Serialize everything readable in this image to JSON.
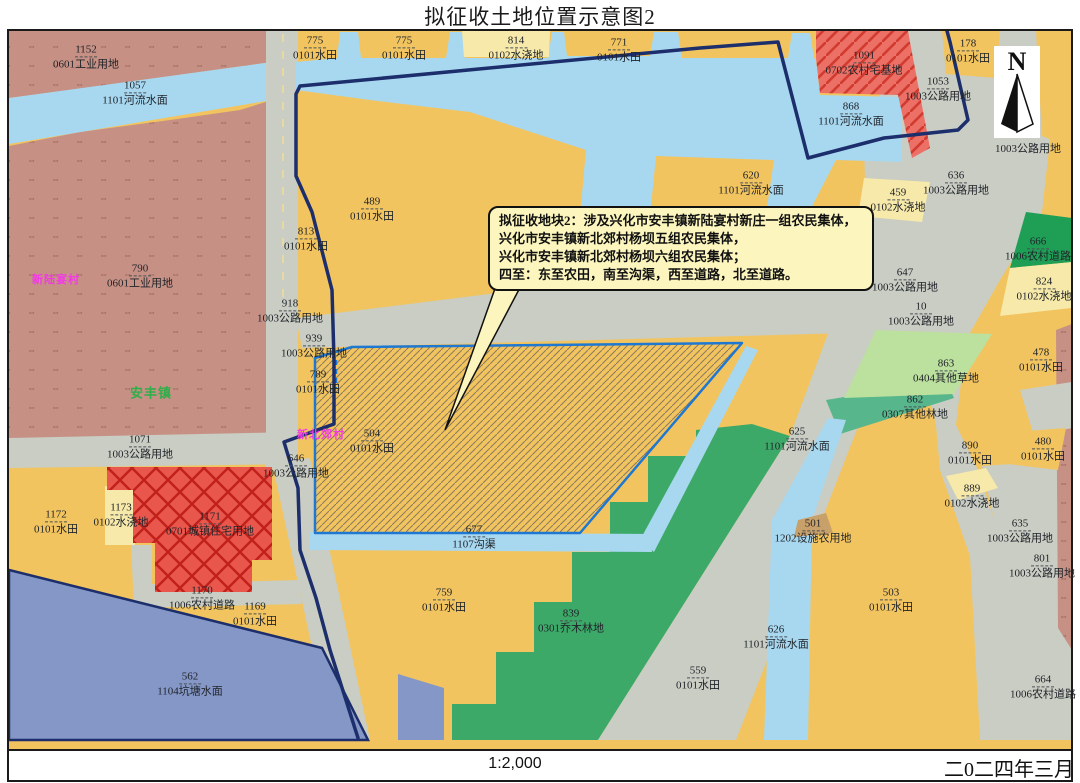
{
  "title": "拟征收土地位置示意图2",
  "footer": {
    "scale": "1:2,000",
    "date": "二0二四年三月"
  },
  "north": {
    "label": "N"
  },
  "callout": {
    "title": "拟征收地块2：",
    "lines": [
      "涉及兴化市安丰镇新陆宴村新庄一组农民集体，",
      "兴化市安丰镇新北郊村杨坝五组农民集体，",
      "兴化市安丰镇新北郊村杨坝六组农民集体；",
      "四至：东至农田，南至沟渠，西至道路，北至道路。"
    ]
  },
  "places": [
    {
      "name": "新陆宴村",
      "x": 56,
      "y": 279,
      "color": "#f23ae6",
      "size": 11
    },
    {
      "name": "安丰镇",
      "x": 151,
      "y": 392,
      "color": "#2fae4a",
      "size": 13
    },
    {
      "name": "新北郊村",
      "x": 321,
      "y": 434,
      "color": "#f23ae6",
      "size": 11
    }
  ],
  "parcels": [
    {
      "n": "1152",
      "u": "0601工业用地",
      "x": 86,
      "y": 57
    },
    {
      "n": "1057",
      "u": "1101河流水面",
      "x": 135,
      "y": 93
    },
    {
      "n": "790",
      "u": "0601工业用地",
      "x": 140,
      "y": 276
    },
    {
      "n": "775",
      "u": "0101水田",
      "x": 315,
      "y": 48
    },
    {
      "n": "775",
      "u": "0101水田",
      "x": 404,
      "y": 48
    },
    {
      "n": "814",
      "u": "0102水浇地",
      "x": 516,
      "y": 48
    },
    {
      "n": "771",
      "u": "0101水田",
      "x": 619,
      "y": 50
    },
    {
      "n": "1091",
      "u": "0702农村宅基地",
      "x": 864,
      "y": 63
    },
    {
      "n": "868",
      "u": "1101河流水面",
      "x": 851,
      "y": 114
    },
    {
      "n": "1053",
      "u": "1003公路用地",
      "x": 938,
      "y": 89
    },
    {
      "n": "178",
      "u": "0101水田",
      "x": 968,
      "y": 51
    },
    {
      "n": "",
      "u": "1003公路用地",
      "x": 1028,
      "y": 149
    },
    {
      "n": "620",
      "u": "1101河流水面",
      "x": 751,
      "y": 183
    },
    {
      "n": "489",
      "u": "0101水田",
      "x": 372,
      "y": 209
    },
    {
      "n": "813",
      "u": "0101水田",
      "x": 306,
      "y": 239
    },
    {
      "n": "918",
      "u": "1003公路用地",
      "x": 290,
      "y": 311
    },
    {
      "n": "939",
      "u": "1003公路用地",
      "x": 314,
      "y": 346
    },
    {
      "n": "789",
      "u": "0101水田",
      "x": 318,
      "y": 382
    },
    {
      "n": "504",
      "u": "0101水田",
      "x": 372,
      "y": 441
    },
    {
      "n": "646",
      "u": "1003公路用地",
      "x": 296,
      "y": 466
    },
    {
      "n": "1071",
      "u": "1003公路用地",
      "x": 140,
      "y": 447
    },
    {
      "n": "636",
      "u": "1003公路用地",
      "x": 956,
      "y": 183
    },
    {
      "n": "459",
      "u": "0102水浇地",
      "x": 898,
      "y": 200
    },
    {
      "n": "647",
      "u": "1003公路用地",
      "x": 905,
      "y": 280
    },
    {
      "n": "10",
      "u": "1003公路用地",
      "x": 921,
      "y": 314
    },
    {
      "n": "666",
      "u": "1006农村道路",
      "x": 1038,
      "y": 249
    },
    {
      "n": "824",
      "u": "0102水浇地",
      "x": 1044,
      "y": 289
    },
    {
      "n": "863",
      "u": "0404其他草地",
      "x": 946,
      "y": 371
    },
    {
      "n": "862",
      "u": "0307其他林地",
      "x": 915,
      "y": 407
    },
    {
      "n": "478",
      "u": "0101水田",
      "x": 1041,
      "y": 360
    },
    {
      "n": "480",
      "u": "0101水田",
      "x": 1043,
      "y": 449
    },
    {
      "n": "890",
      "u": "0101水田",
      "x": 970,
      "y": 453
    },
    {
      "n": "889",
      "u": "0102水浇地",
      "x": 972,
      "y": 496
    },
    {
      "n": "625",
      "u": "1101河流水面",
      "x": 797,
      "y": 439
    },
    {
      "n": "501",
      "u": "1202设施农用地",
      "x": 813,
      "y": 531
    },
    {
      "n": "677",
      "u": "1107沟渠",
      "x": 474,
      "y": 537
    },
    {
      "n": "759",
      "u": "0101水田",
      "x": 444,
      "y": 600
    },
    {
      "n": "839",
      "u": "0301乔木林地",
      "x": 571,
      "y": 621
    },
    {
      "n": "559",
      "u": "0101水田",
      "x": 698,
      "y": 678
    },
    {
      "n": "626",
      "u": "1101河流水面",
      "x": 776,
      "y": 637
    },
    {
      "n": "503",
      "u": "0101水田",
      "x": 891,
      "y": 600
    },
    {
      "n": "635",
      "u": "1003公路用地",
      "x": 1020,
      "y": 531
    },
    {
      "n": "801",
      "u": "1003公路用地",
      "x": 1042,
      "y": 566
    },
    {
      "n": "664",
      "u": "1006农村道路",
      "x": 1043,
      "y": 687
    },
    {
      "n": "1172",
      "u": "0101水田",
      "x": 56,
      "y": 522
    },
    {
      "n": "1173",
      "u": "0102水浇地",
      "x": 121,
      "y": 515
    },
    {
      "n": "1171",
      "u": "0701城镇住宅用地",
      "x": 210,
      "y": 524
    },
    {
      "n": "1170",
      "u": "1006农村道路",
      "x": 202,
      "y": 598
    },
    {
      "n": "1169",
      "u": "0101水田",
      "x": 255,
      "y": 614
    },
    {
      "n": "562",
      "u": "1104坑塘水面",
      "x": 190,
      "y": 684
    }
  ],
  "colors": {
    "farmland_orange": "#F2C45F",
    "irrigated_pale": "#F6E9A9",
    "water_blue": "#A8D8F0",
    "pond_slate": "#8497C7",
    "road_grey": "#C9CDC3",
    "industrial_brown": "#C69084",
    "urban_residential_red": "#E8564C",
    "homestead_red": "#EC7065",
    "forest_green": "#3DA968",
    "rural_road_green": "#1F9E56",
    "other_forest_teal": "#57B68B",
    "grass_lightgreen": "#BCE09E",
    "facility_brown": "#C8A06A",
    "acquisition_outline_blue": "#1E78D2",
    "boundary_navy": "#1C2E6B"
  }
}
